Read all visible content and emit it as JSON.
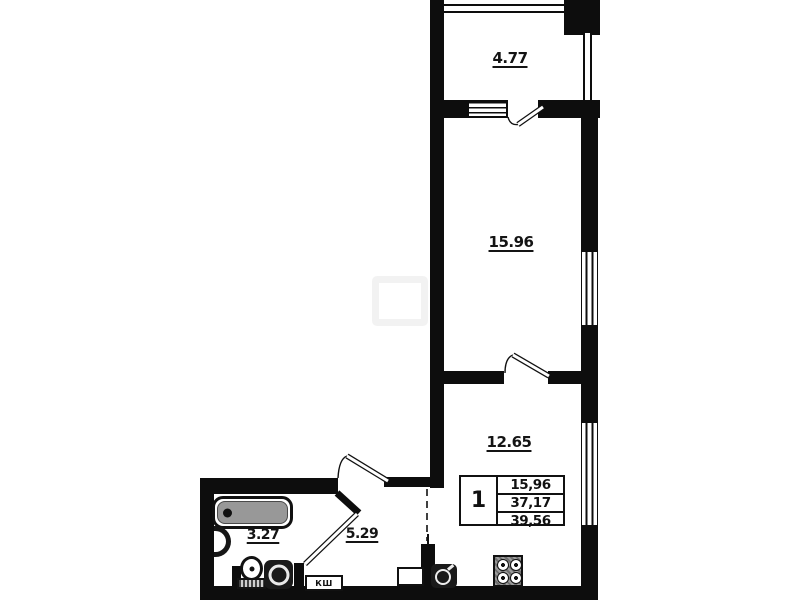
{
  "plan": {
    "title": "1-room apartment floor plan",
    "rooms": {
      "balcony": {
        "label": "4.77"
      },
      "living": {
        "label": "15.96"
      },
      "kitchen": {
        "label": "12.65"
      },
      "hallway": {
        "label": "5.29"
      },
      "bathroom": {
        "label": "3.27"
      }
    },
    "cabinet": {
      "label": "КШ"
    },
    "summary": {
      "rooms_count": "1",
      "living_area": "15,96",
      "apartment_area": "37,17",
      "total_area": "39,56"
    },
    "colors": {
      "wall": "#0d0d0d",
      "background": "#ffffff",
      "tub_fill": "#989898",
      "fixture_dark": "#1a1a1a"
    }
  }
}
